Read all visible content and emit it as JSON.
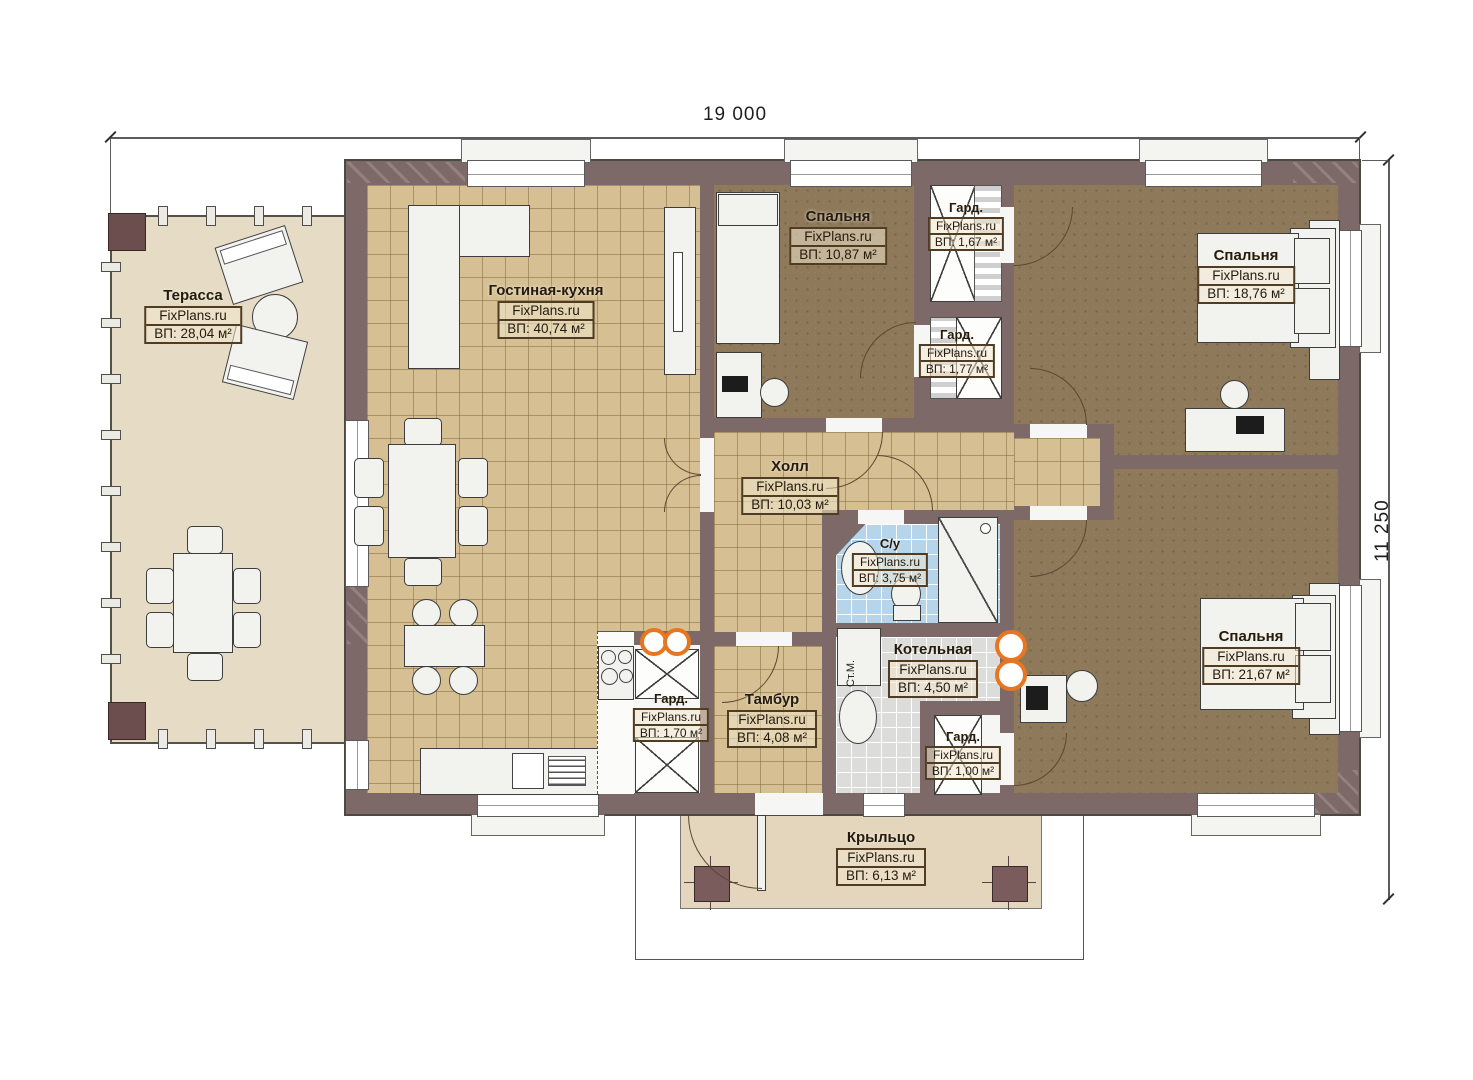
{
  "watermark": "FixPlans.ru",
  "dimensions": {
    "width": "19 000",
    "height": "11 250"
  },
  "annotations": {
    "washing_machine": "Ст.М."
  },
  "rooms": [
    {
      "name": "Терасса",
      "area": "ВП: 28,04 м²"
    },
    {
      "name": "Гостиная-кухня",
      "area": "ВП: 40,74 м²"
    },
    {
      "name": "Спальня",
      "area": "ВП: 10,87 м²"
    },
    {
      "name": "Гард.",
      "area": "ВП: 1,67 м²"
    },
    {
      "name": "Гард.",
      "area": "ВП: 1,77 м²"
    },
    {
      "name": "Спальня",
      "area": "ВП: 18,76 м²"
    },
    {
      "name": "Холл",
      "area": "ВП: 10,03 м²"
    },
    {
      "name": "С/у",
      "area": "ВП: 3,75 м²"
    },
    {
      "name": "Котельная",
      "area": "ВП: 4,50 м²"
    },
    {
      "name": "Гард.",
      "area": "ВП: 1,70 м²"
    },
    {
      "name": "Тамбур",
      "area": "ВП: 4,08 м²"
    },
    {
      "name": "Гард.",
      "area": "ВП: 1,00 м²"
    },
    {
      "name": "Спальня",
      "area": "ВП: 21,67 м²"
    },
    {
      "name": "Крыльцо",
      "area": "ВП: 6,13 м²"
    }
  ],
  "colors": {
    "wall": "#7e6969",
    "tile_floor": "#d6c093",
    "bedroom_floor": "#8e795a",
    "bath_floor": "#b6d5ea",
    "terrace_floor": "#e6dcc5",
    "boiler_floor": "#dcdcda",
    "accent_orange": "#e87520"
  }
}
